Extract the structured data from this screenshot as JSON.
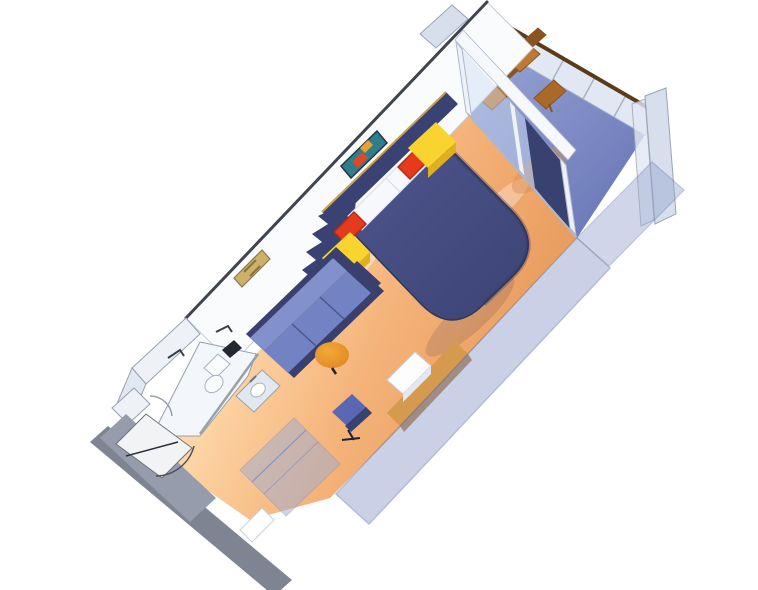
{
  "scene": {
    "type": "3d-rendered-cutaway-floorplan",
    "subject": "cruise ship balcony stateroom",
    "view": "isometric-from-above, room runs diagonally from lower-left entrance to upper-right private balcony",
    "background": "#ffffff"
  },
  "colors": {
    "bg": "#ffffff",
    "wall_cap": "#3f444d",
    "wall_face": "#fafbfd",
    "wall_face_edge": "#c6cdd9",
    "floor_light": "#ffdcae",
    "floor_mid": "#f4b379",
    "floor_deep": "#e89a5c",
    "glow": "#fff3d0",
    "balcony_floor": "#6b79b8",
    "balcony_floor_light": "#93a0d2",
    "balcony_warm": "#d98e4f",
    "bed": "#3d4577",
    "bed_hi": "#4a5288",
    "bed_edge": "#303758",
    "pillow": "#f7f8fb",
    "pillow_edge": "#d8dde8",
    "cushion_red": "#e63a1c",
    "cushion_red_edge": "#b82a12",
    "nightstand": "#f9d42e",
    "nightstand_side": "#dfb01c",
    "headboard": "#3a4273",
    "headboard_trim": "#c9a14e",
    "divider": "#3a4273",
    "sofa_frame": "#39406e",
    "sofa_back": "#8290cc",
    "sofa_seat": "#7282c2",
    "sofa_line": "#4a568e",
    "ottoman": "#f5a838",
    "ottoman_edge": "#d9831f",
    "desk": "#d69a4e",
    "desk_edge": "#ab7431",
    "chair_seat": "#5a68b4",
    "chair_back": "#394170",
    "chair_base": "#1e2230",
    "cabinet": "#fdfdfe",
    "cabinet_edge": "#c9cfdc",
    "cabinet_side": "#e4e8f0",
    "glass": "#cddcf4",
    "glass_frame": "#eef2f8",
    "frame_edge": "#aeb8cc",
    "valance": "#f6f8fc",
    "curtain": "#394170",
    "rail_panel": "#e2e8f3",
    "rail_cap": "#5c3b1a",
    "rail_edge": "#a8b2c6",
    "fin": "#d7deec",
    "fin_edge": "#9aa4b8",
    "ledge": "#b9c0cf",
    "wood": "#bd7a35",
    "wood_dark": "#8a5420",
    "table_wood": "#a96a28",
    "balcony_cushion": "#e85c20",
    "bath_wall": "#eef2f8",
    "bath_wall2": "#e2e8f1",
    "bath_floor": "#f3f6fa",
    "bath_edge": "#98a0ac",
    "fixture": "#fbfcfe",
    "fixture_edge": "#a8b0ba",
    "faucet": "#6a7078",
    "dark_gap": "#23272f",
    "door": "#f2f3f5",
    "door_edge": "#6b717c",
    "door_line": "#2a2e36",
    "arc_line": "#4a4f58",
    "threshold": "#969cab",
    "threshold_dark": "#7e8492",
    "closet_panel": "#9dadd6",
    "closet_edge": "#8494c4",
    "closet_gap": "#ffffff",
    "front_wall": "#96a5d0",
    "front_wall_edge": "#6c7aaa",
    "art_bed_bg": "#2e7e8c",
    "art_bed_accent1": "#d84a28",
    "art_bed_accent2": "#e8a030",
    "art_bed_frame": "#273640",
    "art_sofa_bg": "#cdb06a",
    "art_sofa_mark": "#8a6f3a",
    "art_sofa_frame": "#8a7a4a",
    "towel_bar": "#3a3f47",
    "shadow": "#2c3150",
    "white": "#ffffff"
  },
  "parts": {
    "cabin": [
      "entrance-door",
      "door-swing-arc",
      "bathroom",
      "shower",
      "toilet",
      "sink",
      "closet-sliding-doors",
      "sofa",
      "round-ottoman",
      "double-bed",
      "pillows",
      "red-accent-cushions",
      "yellow-nightstands",
      "zigzag-divider",
      "artwork-above-sofa",
      "artwork-above-bed",
      "vanity-desk",
      "desk-chair",
      "white-cabinet",
      "navy-curtain",
      "glass-balcony-doors"
    ],
    "balcony": [
      "blue-deck",
      "railing-with-teak-top-rail",
      "privacy-partition-fins",
      "wooden-chair-1",
      "wooden-chair-2",
      "wooden-side-table",
      "orange-seat-cushion"
    ]
  }
}
